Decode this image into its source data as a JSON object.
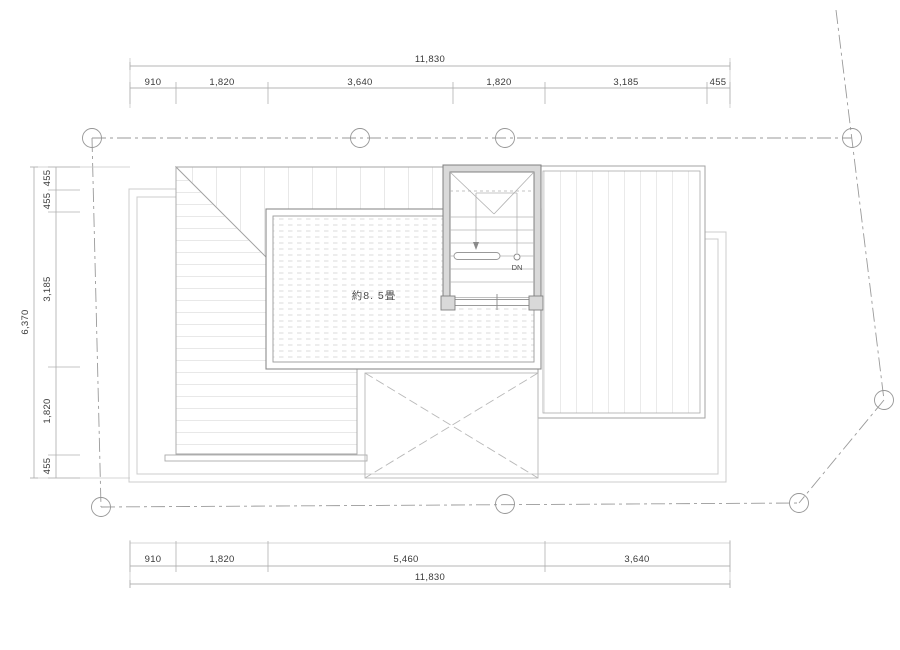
{
  "drawing": {
    "type": "architectural-roof-floor-plan",
    "room_label": "約8. 5畳",
    "stair_label": "DN"
  },
  "dimensions": {
    "top": {
      "total": "11,830",
      "segments": [
        "910",
        "1,820",
        "3,640",
        "1,820",
        "3,185",
        "455"
      ]
    },
    "bottom": {
      "total": "11,830",
      "segments": [
        "910",
        "1,820",
        "5,460",
        "3,640"
      ]
    },
    "left": {
      "total": "6,370",
      "segments": [
        "455",
        "455",
        "3,185",
        "1,820",
        "455"
      ]
    }
  },
  "colors": {
    "dim_line": "#b4b4b4",
    "plan_outline": "#9e9e9e",
    "hatch_line": "#c6c6c6",
    "wall_fill": "#d9d9d9",
    "wall_edge": "#808080",
    "boundary_line": "#9a9a9a",
    "text": "#3a3a3a"
  }
}
